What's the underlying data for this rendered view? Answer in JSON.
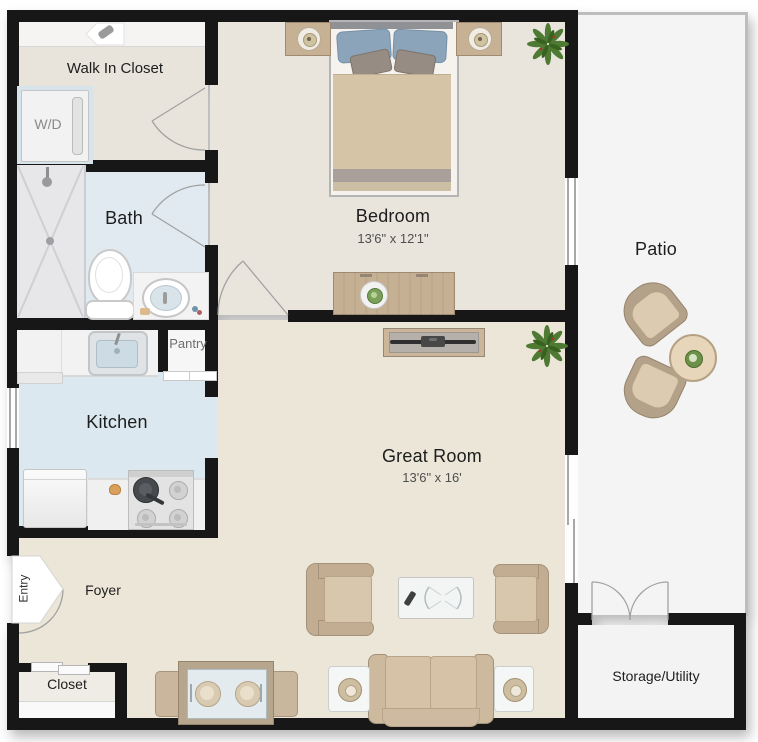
{
  "floorplan": {
    "rooms": {
      "walk_in_closet": {
        "label": "Walk In Closet"
      },
      "bath": {
        "label": "Bath"
      },
      "kitchen": {
        "label": "Kitchen"
      },
      "pantry": {
        "label": "Pantry"
      },
      "bedroom": {
        "label": "Bedroom",
        "dimensions": "13'6\" x 12'1\""
      },
      "great_room": {
        "label": "Great Room",
        "dimensions": "13'6\" x 16'"
      },
      "patio": {
        "label": "Patio"
      },
      "foyer": {
        "label": "Foyer"
      },
      "entry": {
        "label": "Entry"
      },
      "closet": {
        "label": "Closet"
      },
      "storage_utility": {
        "label": "Storage/Utility"
      }
    },
    "appliances": {
      "washer_dryer": {
        "label": "W/D"
      }
    },
    "colors": {
      "wall": "#171717",
      "floor_warm": "#ebe6d8",
      "floor_bedroom": "#e9e5dd",
      "floor_wet_blue": "#dde9f0",
      "floor_outdoor": "#f4f4f4",
      "furniture_tan": "#c9b499",
      "pillow_blue": "#8ba4b9"
    }
  }
}
